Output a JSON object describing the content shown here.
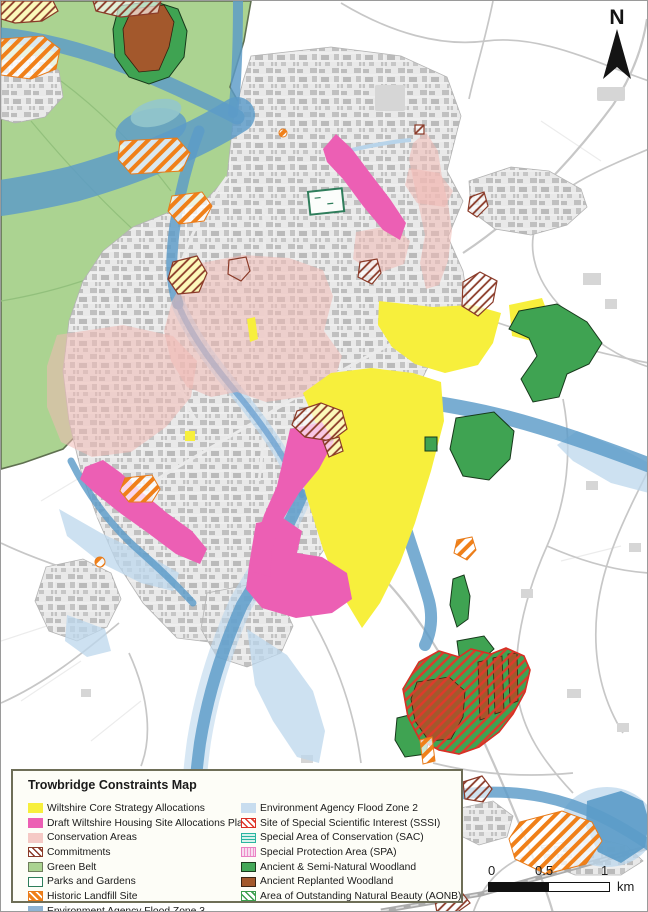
{
  "page": {
    "title": "Trowbridge Constraints Map"
  },
  "north_arrow": {
    "label": "N"
  },
  "scale_bar": {
    "tick0": "0",
    "tick05": "0.5",
    "tick1": "1",
    "unit": "km"
  },
  "legend": {
    "title": "Trowbridge Constraints Map",
    "left": [
      {
        "label": "Wiltshire Core Strategy Allocations",
        "swatch": "yellow-solid"
      },
      {
        "label": "Draft Wiltshire Housing Site Allocations Plan",
        "swatch": "magenta-solid"
      },
      {
        "label": "Conservation Areas",
        "swatch": "light-pink-solid"
      },
      {
        "label": "Commitments",
        "swatch": "dark-red-diagonal-hatch"
      },
      {
        "label": "Green Belt",
        "swatch": "light-green-outline"
      },
      {
        "label": "Parks and Gardens",
        "swatch": "white-teal-outline"
      },
      {
        "label": "Historic Landfill Site",
        "swatch": "orange-diagonal-hatch"
      },
      {
        "label": "Environment Agency Flood Zone 3",
        "swatch": "steel-blue-solid"
      }
    ],
    "right": [
      {
        "label": "Environment Agency Flood Zone 2",
        "swatch": "light-blue-solid"
      },
      {
        "label": "Site of Special Scientific Interest (SSSI)",
        "swatch": "red-diagonal-hatch"
      },
      {
        "label": "Special Area of Conservation (SAC)",
        "swatch": "teal-horizontal-lines"
      },
      {
        "label": "Special Protection Area (SPA)",
        "swatch": "pink-vertical-lines"
      },
      {
        "label": "Ancient & Semi-Natural Woodland",
        "swatch": "green-solid"
      },
      {
        "label": "Ancient Replanted Woodland",
        "swatch": "brown-solid"
      },
      {
        "label": "Area of Outstanding Natural Beauty (AONB)",
        "swatch": "green-diagonal-hatch"
      }
    ]
  },
  "colors": {
    "allocations_yellow": "#f7ef3c",
    "housing_magenta": "#ec5fb4",
    "conservation_pink": "#f5c9c5",
    "commitments_hatch": "#8a3a28",
    "green_belt": "#abd391",
    "parks_outline": "#2e7d5b",
    "landfill_orange": "#f08019",
    "flood_zone3_blue": "#5b9bc8",
    "flood_zone2_blue": "#bcd7ec",
    "sssi_red": "#e0392b",
    "woodland_green": "#3fa352",
    "replanted_brown": "#a3582c",
    "urban_grey": "#c2c2c2"
  }
}
